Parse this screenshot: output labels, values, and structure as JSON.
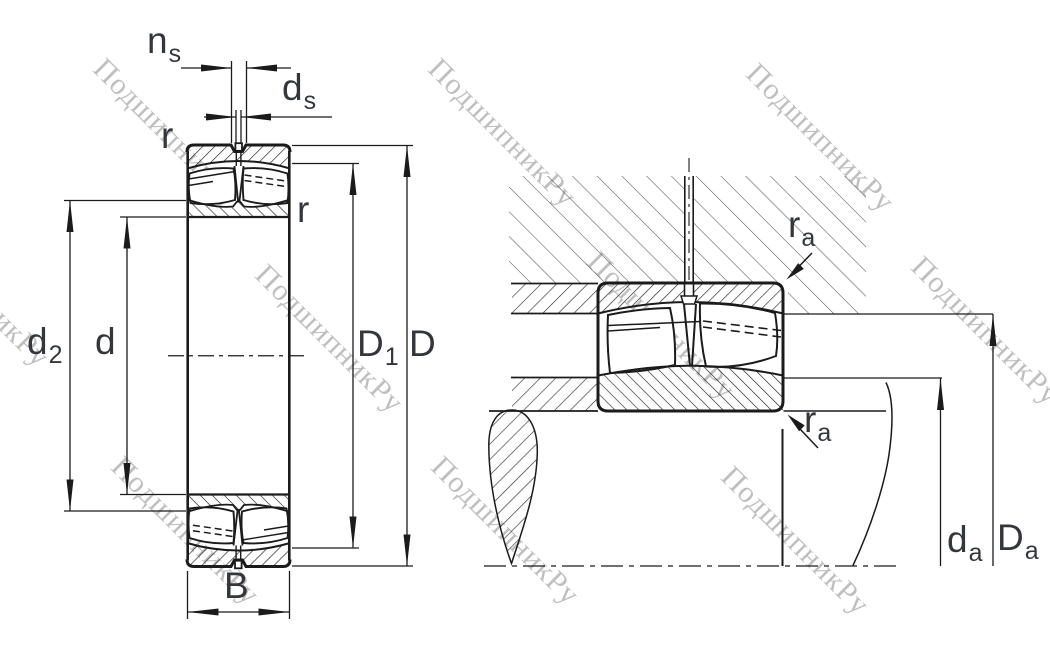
{
  "figure": {
    "title_hint": "spherical roller bearing dimension drawing",
    "watermark_text": "ПодшипникРу",
    "colors": {
      "line": "#1b1b1b",
      "label": "#33373c",
      "watermark": "#bfbfbf",
      "background": "#ffffff"
    }
  },
  "labels": {
    "ns": {
      "base": "n",
      "sub": "s"
    },
    "ds": {
      "base": "d",
      "sub": "s"
    },
    "r_outer": {
      "base": "r"
    },
    "r_inner": {
      "base": "r"
    },
    "d2": {
      "base": "d",
      "sub": "2"
    },
    "d": {
      "base": "d"
    },
    "D1": {
      "base": "D",
      "sub": "1"
    },
    "D": {
      "base": "D"
    },
    "B": {
      "base": "B"
    },
    "ra_top": {
      "base": "r",
      "sub": "a"
    },
    "ra_bottom": {
      "base": "r",
      "sub": "a"
    },
    "da": {
      "base": "d",
      "sub": "a"
    },
    "Da": {
      "base": "D",
      "sub": "a"
    }
  },
  "watermarks": [
    {
      "x": 110,
      "y": 52
    },
    {
      "x": 445,
      "y": 52
    },
    {
      "x": 763,
      "y": 57
    },
    {
      "x": 928,
      "y": 250
    },
    {
      "x": 272,
      "y": 258
    },
    {
      "x": 604,
      "y": 245
    },
    {
      "x": 128,
      "y": 450
    },
    {
      "x": 448,
      "y": 450
    },
    {
      "x": 738,
      "y": 460
    },
    {
      "x": -82,
      "y": 212
    }
  ]
}
